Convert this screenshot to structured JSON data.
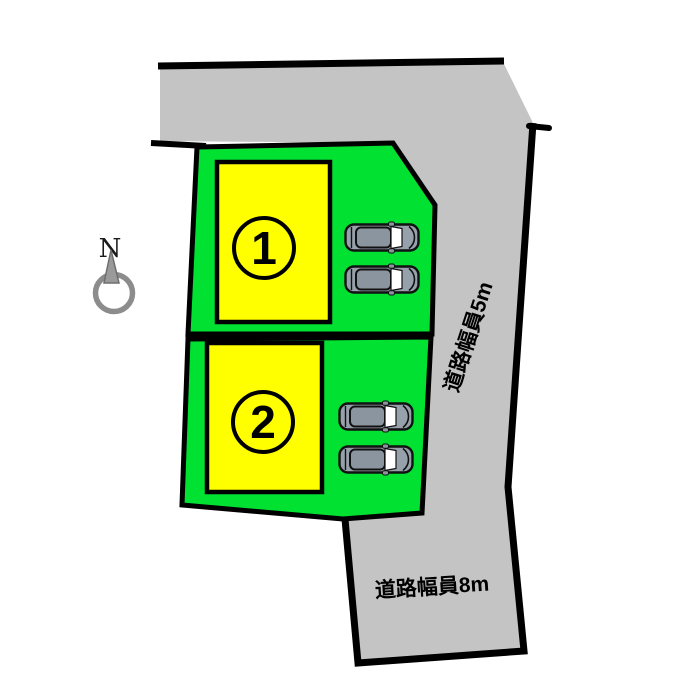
{
  "diagram": {
    "type": "real-estate-site-plan",
    "compass": {
      "label": "N"
    },
    "roads": [
      {
        "id": "east-road",
        "label": "道路幅員5m",
        "width_m": 5
      },
      {
        "id": "south-road",
        "label": "道路幅員8m",
        "width_m": 8
      }
    ],
    "lots": [
      {
        "number": "1",
        "parking_spaces": 2
      },
      {
        "number": "2",
        "parking_spaces": 2
      }
    ],
    "colors": {
      "road_gray": "#c4c4c4",
      "lot_green": "#00e132",
      "building_yellow": "#ffff00",
      "outline_black": "#000000",
      "car_body": "#97a1ab",
      "car_roof": "#8b95a0",
      "car_glass": "#ffffff",
      "compass_gray": "#8c8c8c",
      "needle_gray": "#9a9a9a"
    }
  }
}
